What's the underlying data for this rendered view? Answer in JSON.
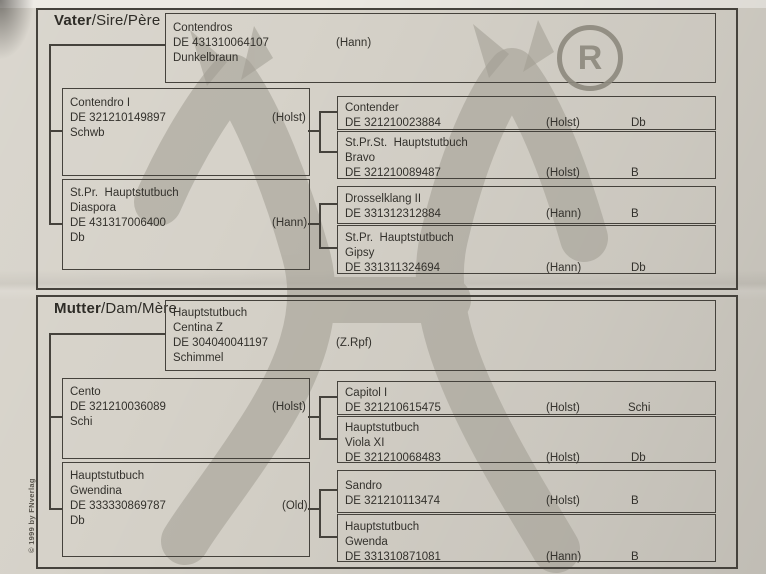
{
  "document": {
    "registered_symbol": "R",
    "copyright_note": "© 1999 by FNverlag"
  },
  "sire_section": {
    "label": {
      "bold": "Vater",
      "rest": "/Sire/Père"
    },
    "root": {
      "lines": [
        "Contendros",
        "DE 431310064107",
        "Dunkelbraun"
      ],
      "region": "(Hann)"
    },
    "parent1": {
      "lines": [
        "Contendro I",
        "DE 321210149897",
        "Schwb"
      ],
      "region": "(Holst)"
    },
    "parent2": {
      "lines": [
        "St.Pr.  Hauptstutbuch",
        "Diaspora",
        "DE 431317006400",
        "Db"
      ],
      "region": "(Hann)"
    },
    "gp1": {
      "lines": [
        "Contender",
        "DE 321210023884"
      ],
      "region": "(Holst)",
      "color": "Db"
    },
    "gp2": {
      "lines": [
        "St.Pr.St.  Hauptstutbuch",
        "Bravo",
        "DE 321210089487"
      ],
      "region": "(Holst)",
      "color": "B"
    },
    "gp3": {
      "lines": [
        "Drosselklang II",
        "DE 331312312884"
      ],
      "region": "(Hann)",
      "color": "B"
    },
    "gp4": {
      "lines": [
        "St.Pr.  Hauptstutbuch",
        "Gipsy",
        "DE 331311324694"
      ],
      "region": "(Hann)",
      "color": "Db"
    }
  },
  "dam_section": {
    "label": {
      "bold": "Mutter",
      "rest": "/Dam/Mère"
    },
    "root": {
      "lines": [
        "Hauptstutbuch",
        "Centina Z",
        "DE 304040041197",
        "Schimmel"
      ],
      "region": "(Z.Rpf)"
    },
    "parent1": {
      "lines": [
        "Cento",
        "DE 321210036089",
        "Schi"
      ],
      "region": "(Holst)"
    },
    "parent2": {
      "lines": [
        "Hauptstutbuch",
        "Gwendina",
        "DE 333330869787",
        "Db"
      ],
      "region": "(Old)"
    },
    "gp1": {
      "lines": [
        "Capitol I",
        "DE 321210615475"
      ],
      "region": "(Holst)",
      "color": "Schi"
    },
    "gp2": {
      "lines": [
        "Hauptstutbuch",
        "Viola XI",
        "DE 321210068483"
      ],
      "region": "(Holst)",
      "color": "Db"
    },
    "gp3": {
      "lines": [
        "Sandro",
        "DE 321210113474"
      ],
      "region": "(Holst)",
      "color": "B"
    },
    "gp4": {
      "lines": [
        "Hauptstutbuch",
        "Gwenda",
        "DE 331310871081"
      ],
      "region": "(Hann)",
      "color": "B"
    }
  }
}
